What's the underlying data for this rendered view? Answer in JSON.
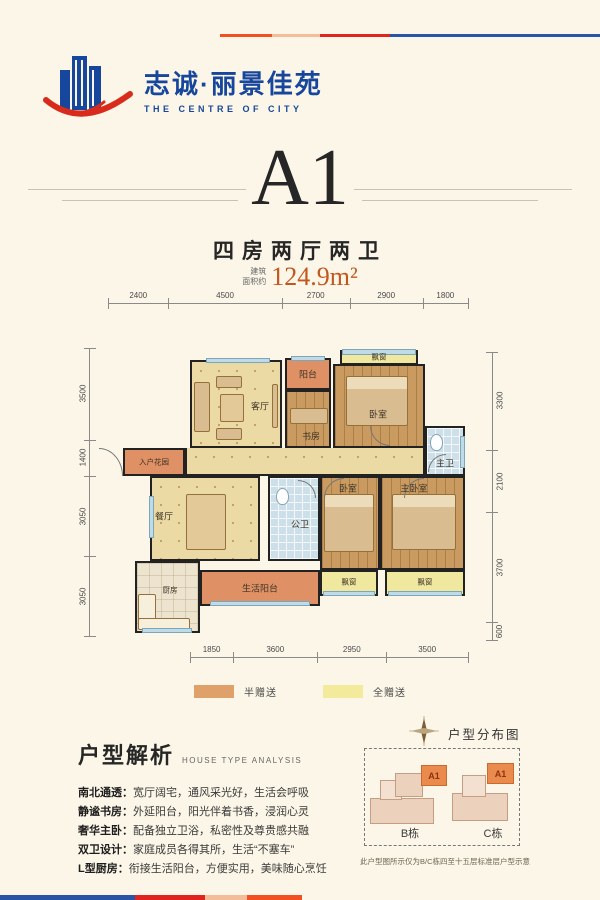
{
  "brand": {
    "name": "志诚·丽景佳苑",
    "tagline": "THE CENTRE OF CITY",
    "logo_colors": {
      "blue": "#17479c",
      "red": "#d92b1b"
    }
  },
  "title": {
    "unit": "A1",
    "subtitle": "四房两厅两卫",
    "area_label_line1": "建筑",
    "area_label_line2": "面积约",
    "area_value": "124.9m²",
    "area_color": "#c3581f"
  },
  "plan": {
    "dims_top": [
      "2400",
      "4500",
      "2700",
      "2900",
      "1800"
    ],
    "dims_bottom": [
      "1850",
      "3600",
      "2950",
      "3500"
    ],
    "dims_left": [
      "3500",
      "1400",
      "3050",
      "3050"
    ],
    "dims_right": [
      "3300",
      "2100",
      "3700",
      "600"
    ],
    "rooms": {
      "living": "客厅",
      "balcony": "阳台",
      "study": "书房",
      "bay_top": "飘窗",
      "bedroom_tr": "卧室",
      "master_bath": "主卫",
      "entry_garden": "入户花园",
      "dining": "餐厅",
      "public_bath": "公卫",
      "bedroom_mid": "卧室",
      "master_bedroom": "主卧室",
      "kitchen": "厨房",
      "utility_balcony": "生活阳台",
      "bay_bottom_1": "飘窗",
      "bay_bottom_2": "飘窗"
    }
  },
  "legend": {
    "items": [
      {
        "label": "半赠送",
        "color": "#e0a069"
      },
      {
        "label": "全赠送",
        "color": "#f3ea9c"
      }
    ]
  },
  "analysis": {
    "heading": "户型解析",
    "heading_en": "HOUSE TYPE ANALYSIS",
    "items": [
      {
        "term": "南北通透：",
        "desc": "宽厅阔宅，通风采光好，生活会呼吸"
      },
      {
        "term": "静谧书房：",
        "desc": "外延阳台，阳光伴着书香，浸润心灵"
      },
      {
        "term": "奢华主卧：",
        "desc": "配备独立卫浴，私密性及尊贵感共融"
      },
      {
        "term": "双卫设计：",
        "desc": "家庭成员各得其所，生活“不塞车”"
      },
      {
        "term": "L型厨房：",
        "desc": "衔接生活阳台，方便实用，美味随心烹饪"
      }
    ]
  },
  "distribution": {
    "title": "户型分布图",
    "building_b": "B栋",
    "building_c": "C栋",
    "unit_b": "A1",
    "unit_c": "A1",
    "note": "此户型图所示仅为B/C栋四至十五层标准层户型示意"
  }
}
